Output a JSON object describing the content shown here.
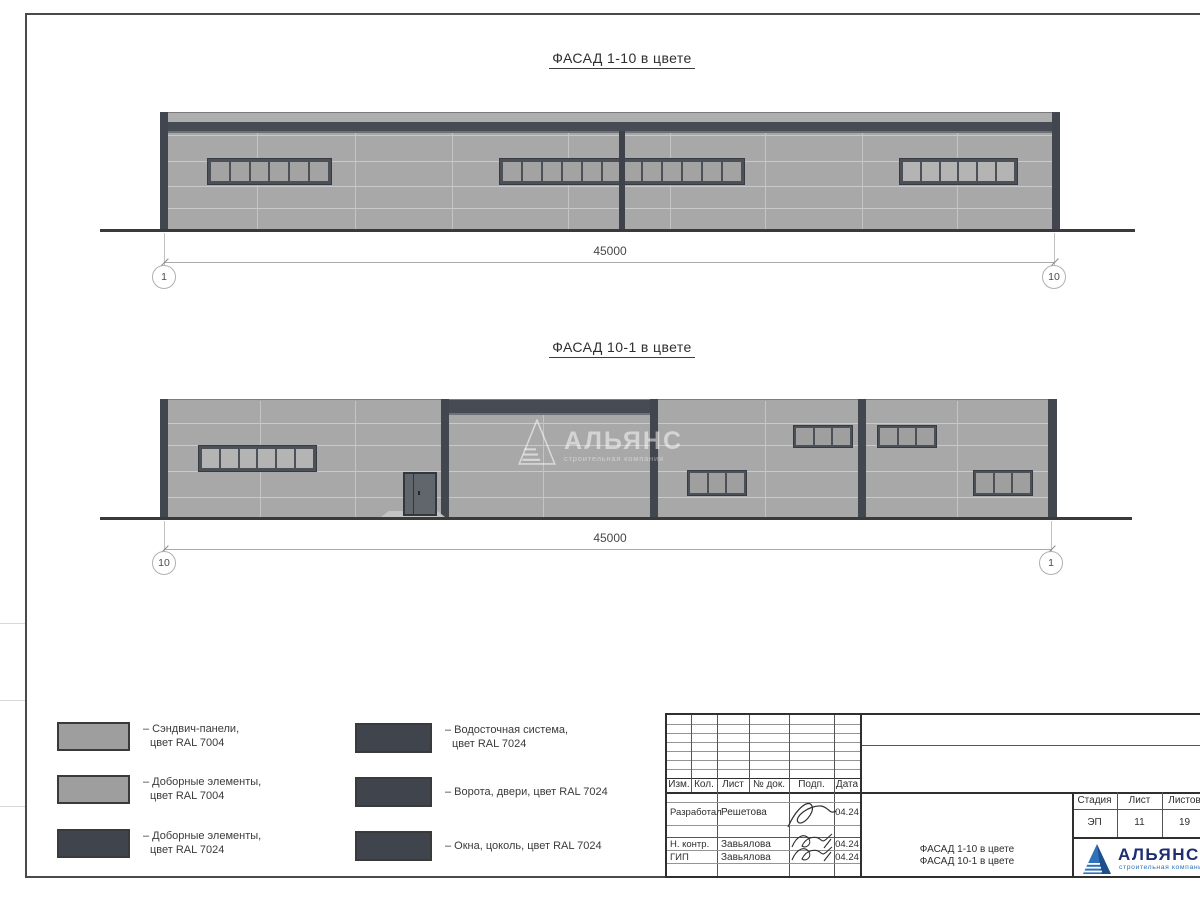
{
  "facade1": {
    "title": "ФАСАД 1-10 в цвете",
    "dimension": "45000",
    "axis_left": "1",
    "axis_right": "10"
  },
  "facade2": {
    "title": "ФАСАД 10-1 в цвете",
    "dimension": "45000",
    "axis_left": "10",
    "axis_right": "1"
  },
  "watermark": {
    "name": "АЛЬЯНС",
    "tagline": "строительная компания"
  },
  "legend": {
    "items": [
      {
        "line1": "– Сэндвич-панели,",
        "line2": "цвет RAL 7004",
        "swatch": "#9e9e9e"
      },
      {
        "line1": "– Доборные элементы,",
        "line2": "цвет RAL 7004",
        "swatch": "#9e9e9e"
      },
      {
        "line1": "– Доборные элементы,",
        "line2": "цвет RAL 7024",
        "swatch": "#3f444d"
      },
      {
        "line1": "– Водосточная система,",
        "line2": "цвет RAL 7024",
        "swatch": "#3f444d"
      },
      {
        "line1": "– Ворота, двери, цвет RAL 7024",
        "line2": "",
        "swatch": "#3f444d"
      },
      {
        "line1": "– Окна, цоколь, цвет RAL 7024",
        "line2": "",
        "swatch": "#3f444d"
      }
    ]
  },
  "title_block": {
    "columns": [
      "Изм.",
      "Кол.",
      "Лист",
      "№ док.",
      "Подп.",
      "Дата"
    ],
    "rows": [
      {
        "role": "Разработал",
        "name": "Решетова",
        "date": "04.24"
      },
      {
        "role": "Н. контр.",
        "name": "Завьялова",
        "date": "04.24"
      },
      {
        "role": "ГИП",
        "name": "Завьялова",
        "date": "04.24"
      }
    ],
    "doc_title_line1": "ФАСАД 1-10 в цвете",
    "doc_title_line2": "ФАСАД 10-1 в цвете",
    "stage_label": "Стадия",
    "stage_value": "ЭП",
    "sheet_label": "Лист",
    "sheet_value": "11",
    "sheets_label": "Листов",
    "sheets_value": "19",
    "company_name": "АЛЬЯНС",
    "company_tagline": "строительная компания"
  },
  "colors": {
    "ral7004": "#9e9e9e",
    "ral7024": "#3f444d",
    "wall": "#a8a8a8",
    "logo_blue": "#2f72b8",
    "logo_navy": "#1f2d73"
  }
}
